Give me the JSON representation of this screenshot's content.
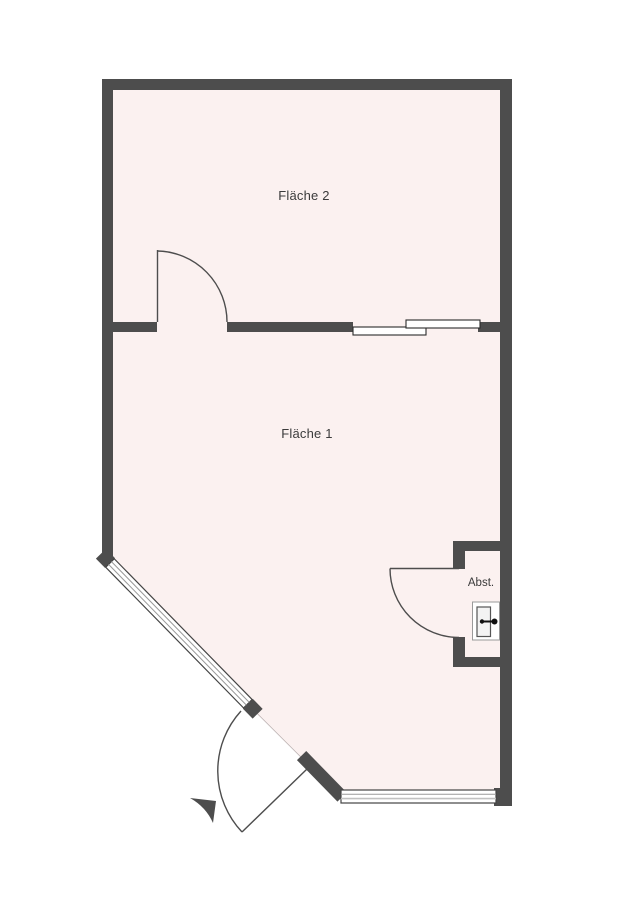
{
  "plan": {
    "type": "floor-plan",
    "rooms": [
      {
        "id": "flaeche-2",
        "label": "Fläche 2"
      },
      {
        "id": "flaeche-1",
        "label": "Fläche 1"
      },
      {
        "id": "abstellraum",
        "label": "Abst."
      }
    ],
    "features": [
      "swing-door-between-flaeche-1-and-flaeche-2",
      "sliding-door-in-dividing-wall",
      "diagonal-window-wall-bottom-left",
      "entrance-swing-door-bottom",
      "bottom-window",
      "storage-closet-with-swing-door",
      "boiler-symbol-in-closet",
      "direction-triangle-marker"
    ]
  },
  "colors": {
    "background": "#ffffff",
    "wall": "#4d4d4d",
    "floor": "#fbf1f0",
    "floor_edge": "#bdb3b3",
    "door_stroke": "#4d4d4d",
    "window_fill": "#ffffff",
    "window_edge": "#444444",
    "window_line": "#999999",
    "panel_edge": "#2b2b2b",
    "label": "#3b3b3b",
    "fixture_edge": "#9a9a9a",
    "fixture_inner_edge": "#555555",
    "fixture_symbol": "#111111"
  }
}
